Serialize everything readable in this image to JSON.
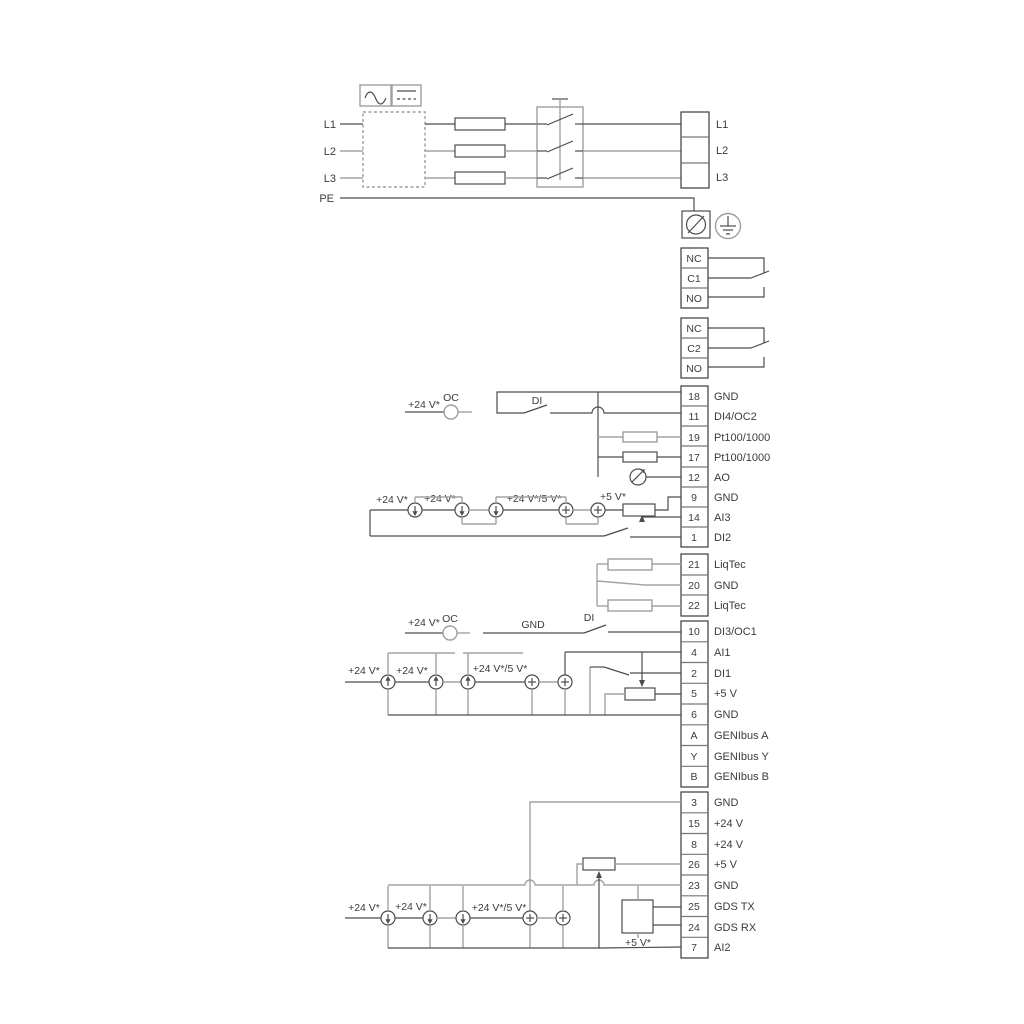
{
  "diagram_type": "pump-drive-wiring-diagram",
  "colors": {
    "line_dark": "#4c4c4c",
    "line_gray": "#a3a3a3",
    "text": "#3b3b3b",
    "background": "#ffffff"
  },
  "power": {
    "inputs": [
      "L1",
      "L2",
      "L3",
      "PE"
    ],
    "outputs": [
      "L1",
      "L2",
      "L3"
    ],
    "icons": {
      "converter_ac": "ac-wave-icon",
      "converter_dc": "dc-line-icon",
      "fuse": "fuse-icon",
      "main_switch": "disconnect-switch-icon",
      "screw_terminal": "screw-terminal-icon",
      "earth": "protective-earth-icon"
    }
  },
  "relays": {
    "relay1": [
      "NC",
      "C1",
      "NO"
    ],
    "relay2": [
      "NC",
      "C2",
      "NO"
    ]
  },
  "strips": {
    "io_top": [
      {
        "num": "18",
        "label": "GND"
      },
      {
        "num": "11",
        "label": "DI4/OC2"
      },
      {
        "num": "19",
        "label": "Pt100/1000"
      },
      {
        "num": "17",
        "label": "Pt100/1000"
      },
      {
        "num": "12",
        "label": "AO"
      },
      {
        "num": "9",
        "label": "GND"
      },
      {
        "num": "14",
        "label": "AI3"
      },
      {
        "num": "1",
        "label": "DI2"
      }
    ],
    "liqtec": [
      {
        "num": "21",
        "label": "LiqTec"
      },
      {
        "num": "20",
        "label": "GND"
      },
      {
        "num": "22",
        "label": "LiqTec"
      }
    ],
    "io_mid": [
      {
        "num": "10",
        "label": "DI3/OC1"
      },
      {
        "num": "4",
        "label": "AI1"
      },
      {
        "num": "2",
        "label": "DI1"
      },
      {
        "num": "5",
        "label": "+5 V"
      },
      {
        "num": "6",
        "label": "GND"
      },
      {
        "num": "A",
        "label": "GENIbus A"
      },
      {
        "num": "Y",
        "label": "GENIbus Y"
      },
      {
        "num": "B",
        "label": "GENIbus B"
      }
    ],
    "io_bottom": [
      {
        "num": "3",
        "label": "GND"
      },
      {
        "num": "15",
        "label": "+24 V"
      },
      {
        "num": "8",
        "label": "+24 V"
      },
      {
        "num": "26",
        "label": "+5 V"
      },
      {
        "num": "23",
        "label": "GND"
      },
      {
        "num": "25",
        "label": "GDS TX"
      },
      {
        "num": "24",
        "label": "GDS RX"
      },
      {
        "num": "7",
        "label": "AI2"
      }
    ]
  },
  "annotations": {
    "plus24": "+24 V*",
    "plus24or5": "+24 V*/5 V*",
    "plus5": "+5 V*",
    "oc": "OC",
    "di": "DI",
    "gnd": "GND"
  }
}
